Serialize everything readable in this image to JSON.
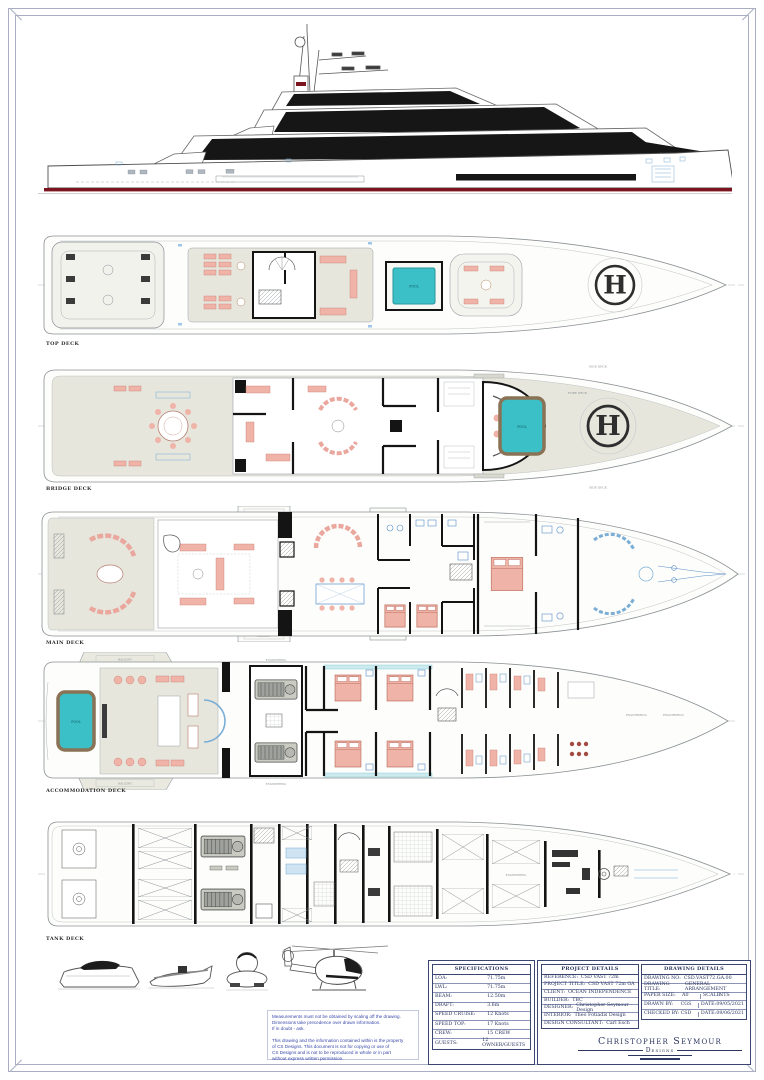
{
  "sheet": {
    "deck_labels": [
      "TOP DECK",
      "BRIDGE DECK",
      "MAIN DECK",
      "ACCOMMODATION DECK",
      "TANK DECK"
    ],
    "helipad_letter": "H",
    "labels": {
      "pool": "POOL",
      "balcony": "BALCONY",
      "side_deck": "SIDE DECK",
      "fore_deck": "FORE DECK",
      "engineering": "ENGINEERING"
    }
  },
  "colors": {
    "pool_teal": "#3cc0c8",
    "pool_rim_brown": "#8a7355",
    "furniture_salmon": "#f0b3a8",
    "waterline_red": "#7a1520",
    "table_navy": "#3a4670",
    "note_blue": "#3a49a8",
    "deck_fill": "#e6e6dd"
  },
  "disclaimer": {
    "lines": [
      "Measurements must not be obtained by scaling off the drawing.",
      "Dimensions take precedence over drawn information.",
      "If in doubt - ask.",
      "",
      "This drawing and the information contained within is the property",
      "of CS Designs. This document is not for copying or use of",
      "CS Designs and is not to be reproduced in whole or in part",
      "without express written permission."
    ]
  },
  "specifications": {
    "title": "SPECIFICATIONS",
    "rows": [
      [
        "LOA:",
        "71.75m"
      ],
      [
        "LWL:",
        "71.75m"
      ],
      [
        "BEAM:",
        "12.50m"
      ],
      [
        "DRAFT:",
        "3.6m"
      ],
      [
        "SPEED CRUISE:",
        "12 Knots"
      ],
      [
        "SPEED TOP:",
        "17 Knots"
      ],
      [
        "CREW:",
        "15 CREW"
      ],
      [
        "GUESTS:",
        "12 OWNER/GUESTS"
      ]
    ]
  },
  "project_details": {
    "title": "PROJECT DETAILS",
    "rows": [
      [
        "REFERENCE:",
        "CSD VAST 72m"
      ],
      [
        "PROJECT TITLE:",
        "CSD VAST 72m GA"
      ],
      [
        "CLIENT:",
        "OCEAN INDEPENDENCE"
      ],
      [
        "BUILDER:",
        "TBC"
      ],
      [
        "DESIGNER:",
        "Christopher Seymour Design"
      ],
      [
        "INTERIOR:",
        "Theo Fotiadis Design"
      ],
      [
        "DESIGN CONSULTANT:",
        "Carl Esch"
      ]
    ]
  },
  "drawing_details": {
    "title": "DRAWING DETAILS",
    "rows_full": [
      [
        "DRAWING NO:",
        "CSD.VAST72.GA.00"
      ],
      [
        "DRAWING TITLE:",
        "GENERAL ARRANGEMENT"
      ]
    ],
    "rows_split": [
      [
        "PAPER SIZE:",
        "A0",
        "SCALE:",
        "NTS"
      ],
      [
        "DRAWN BY:",
        "CGS",
        "DATE:",
        "09/05/2021"
      ],
      [
        "CHECKED BY:",
        "CSD",
        "DATE:",
        "09/06/2021"
      ]
    ]
  },
  "logo": {
    "line1": "Christopher Seymour",
    "line2": "Designs"
  }
}
